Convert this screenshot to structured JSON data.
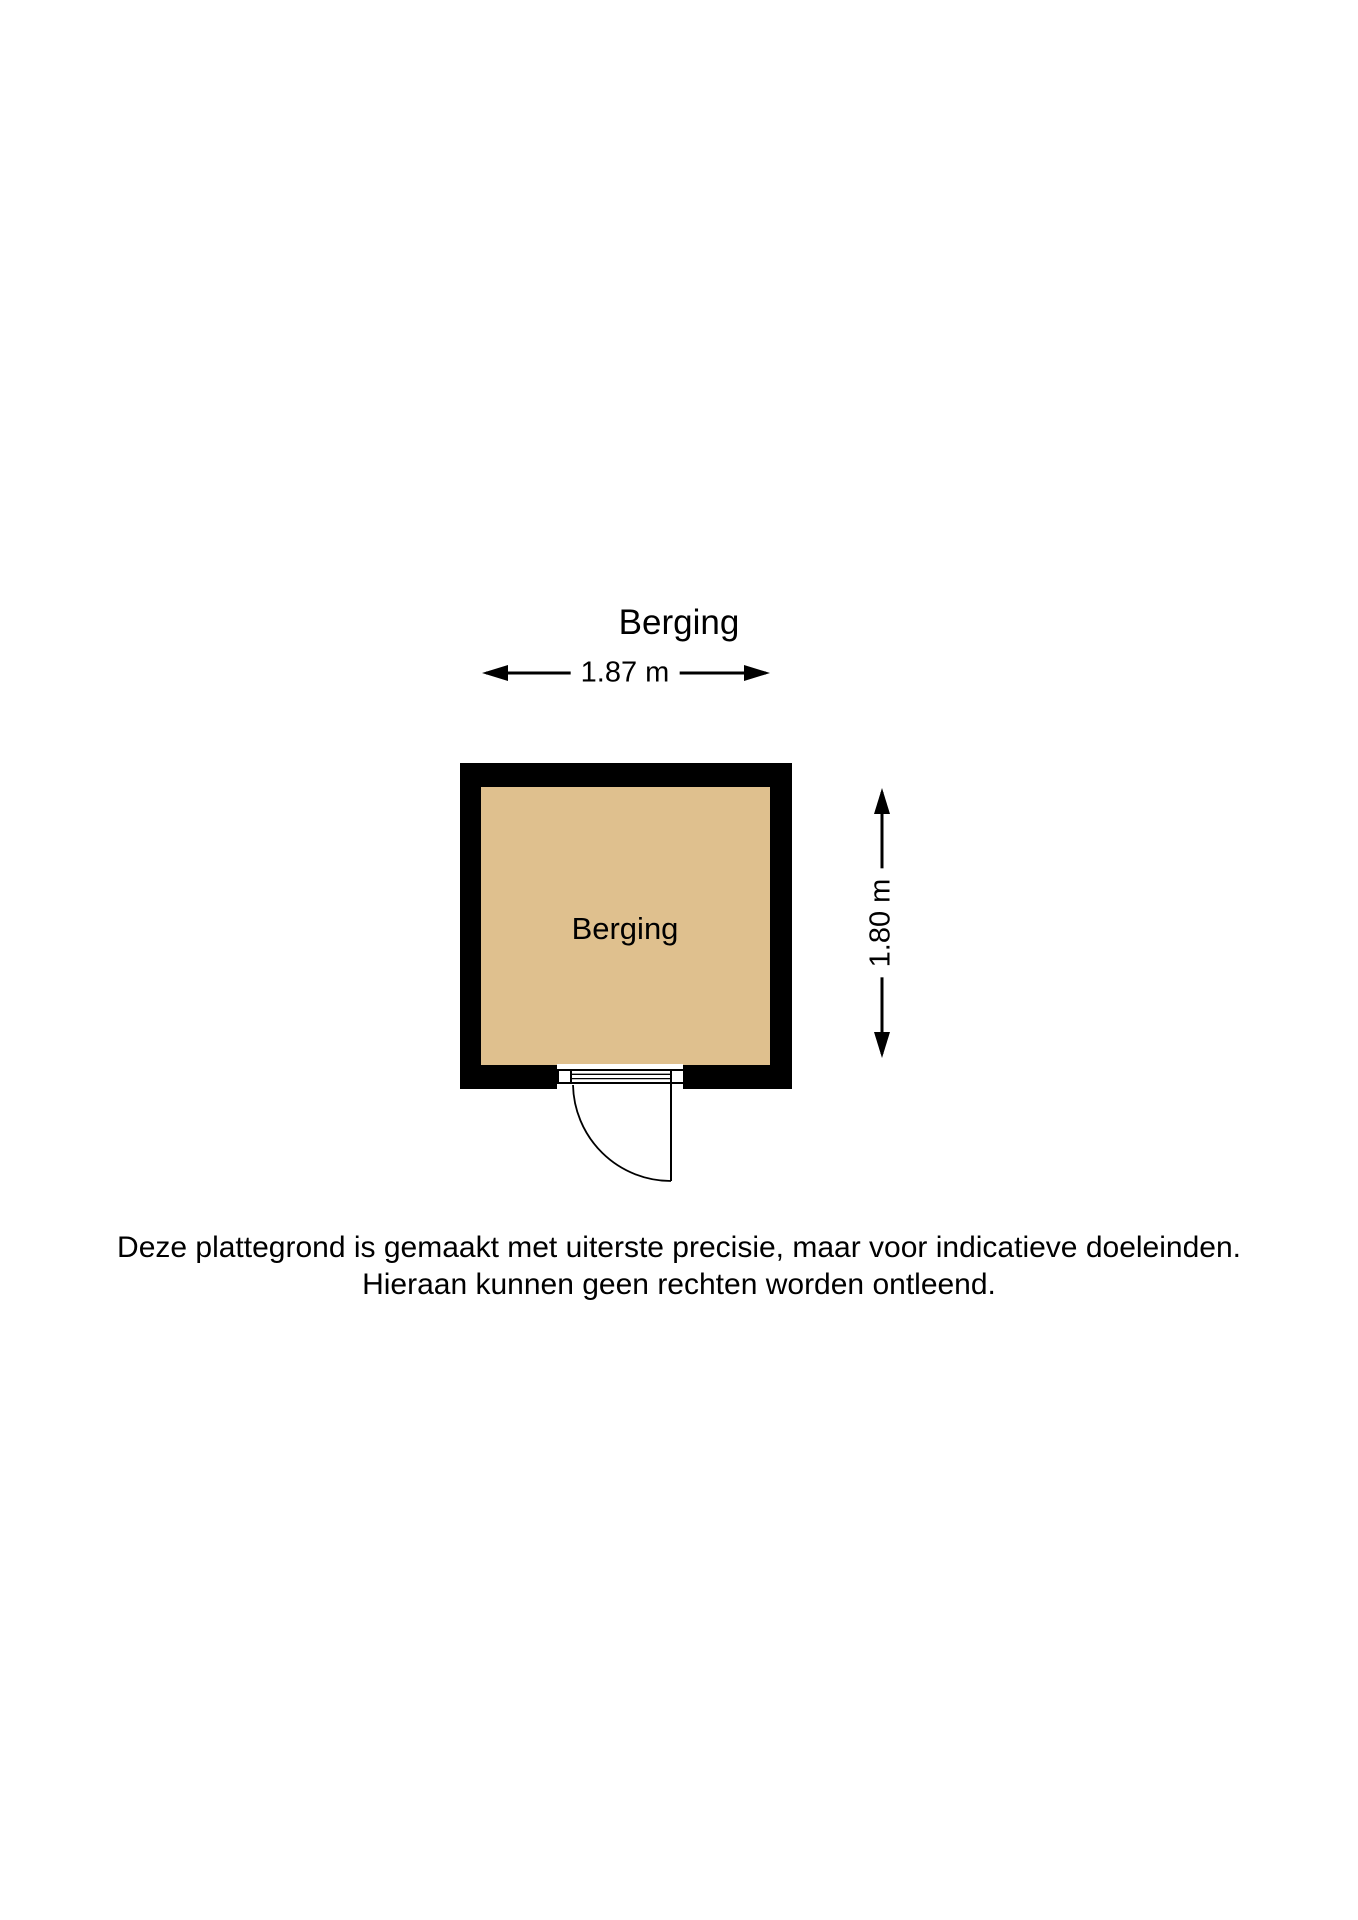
{
  "plan": {
    "title": "Berging",
    "room": {
      "label": "Berging",
      "floor_color": "#dfc08e",
      "wall_color": "#000000"
    },
    "dimensions": {
      "width_label": "1.87 m",
      "height_label": "1.80 m"
    }
  },
  "disclaimer": {
    "line1": "Deze plattegrond is gemaakt met uiterste precisie, maar voor indicatieve doeleinden.",
    "line2": "Hieraan kunnen geen rechten worden ontleend."
  }
}
